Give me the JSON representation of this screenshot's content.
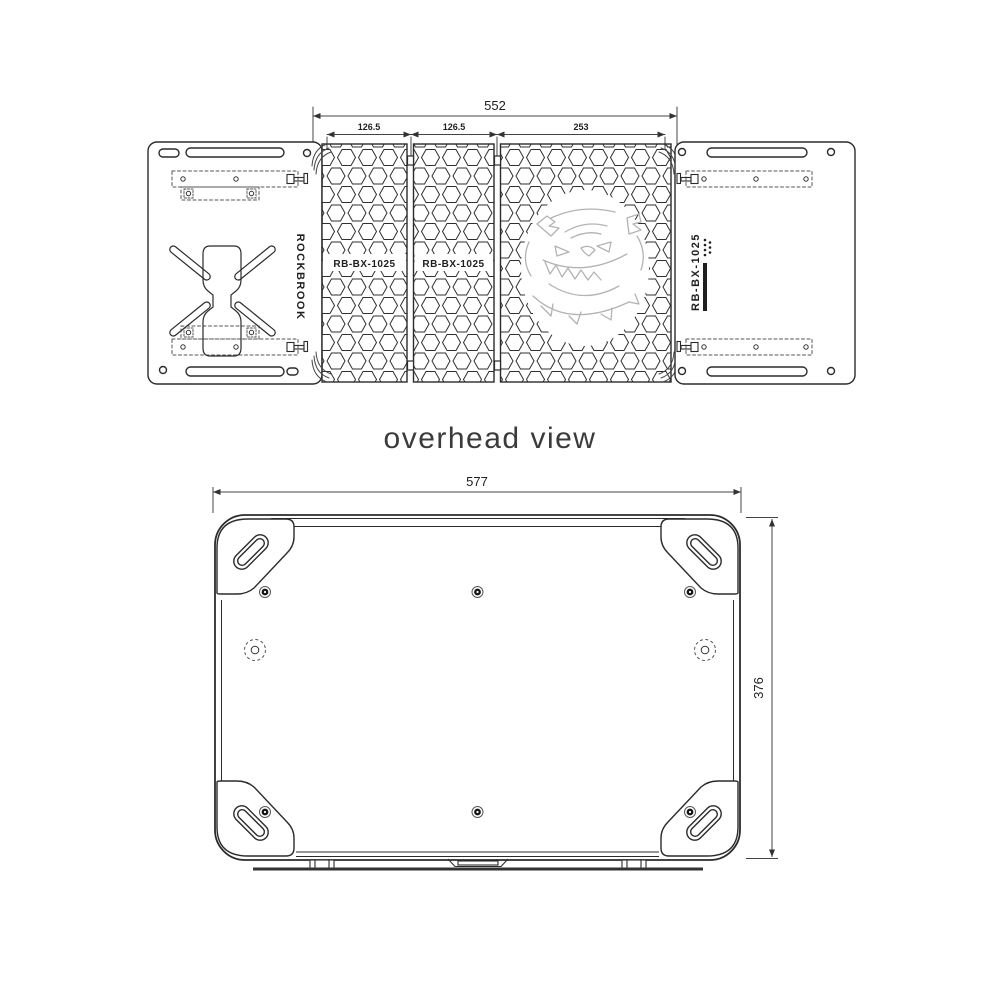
{
  "heading": {
    "text": "overhead view"
  },
  "top_view": {
    "description": "unfolded table, overhead view",
    "dims": {
      "total": "552",
      "seg1": "126.5",
      "seg2": "126.5",
      "seg3": "253"
    },
    "left_panel": {
      "brand_label": "ROCKBROOK"
    },
    "panel_labels": [
      "RB-BX-1025",
      "RB-BX-1025"
    ],
    "right_panel": {
      "model_label": "RB-BX-1025"
    },
    "graphic_name": "bulldog-skull-emblem"
  },
  "bottom_view": {
    "description": "folded case underside view",
    "dims": {
      "width": "577",
      "height": "376"
    }
  },
  "colors": {
    "line": "#2b2b2b",
    "dim_line": "#444444",
    "text": "#1f1f1f",
    "graphic": "#b3b3b3",
    "heading": "#3b3b3b",
    "background": "#ffffff"
  }
}
